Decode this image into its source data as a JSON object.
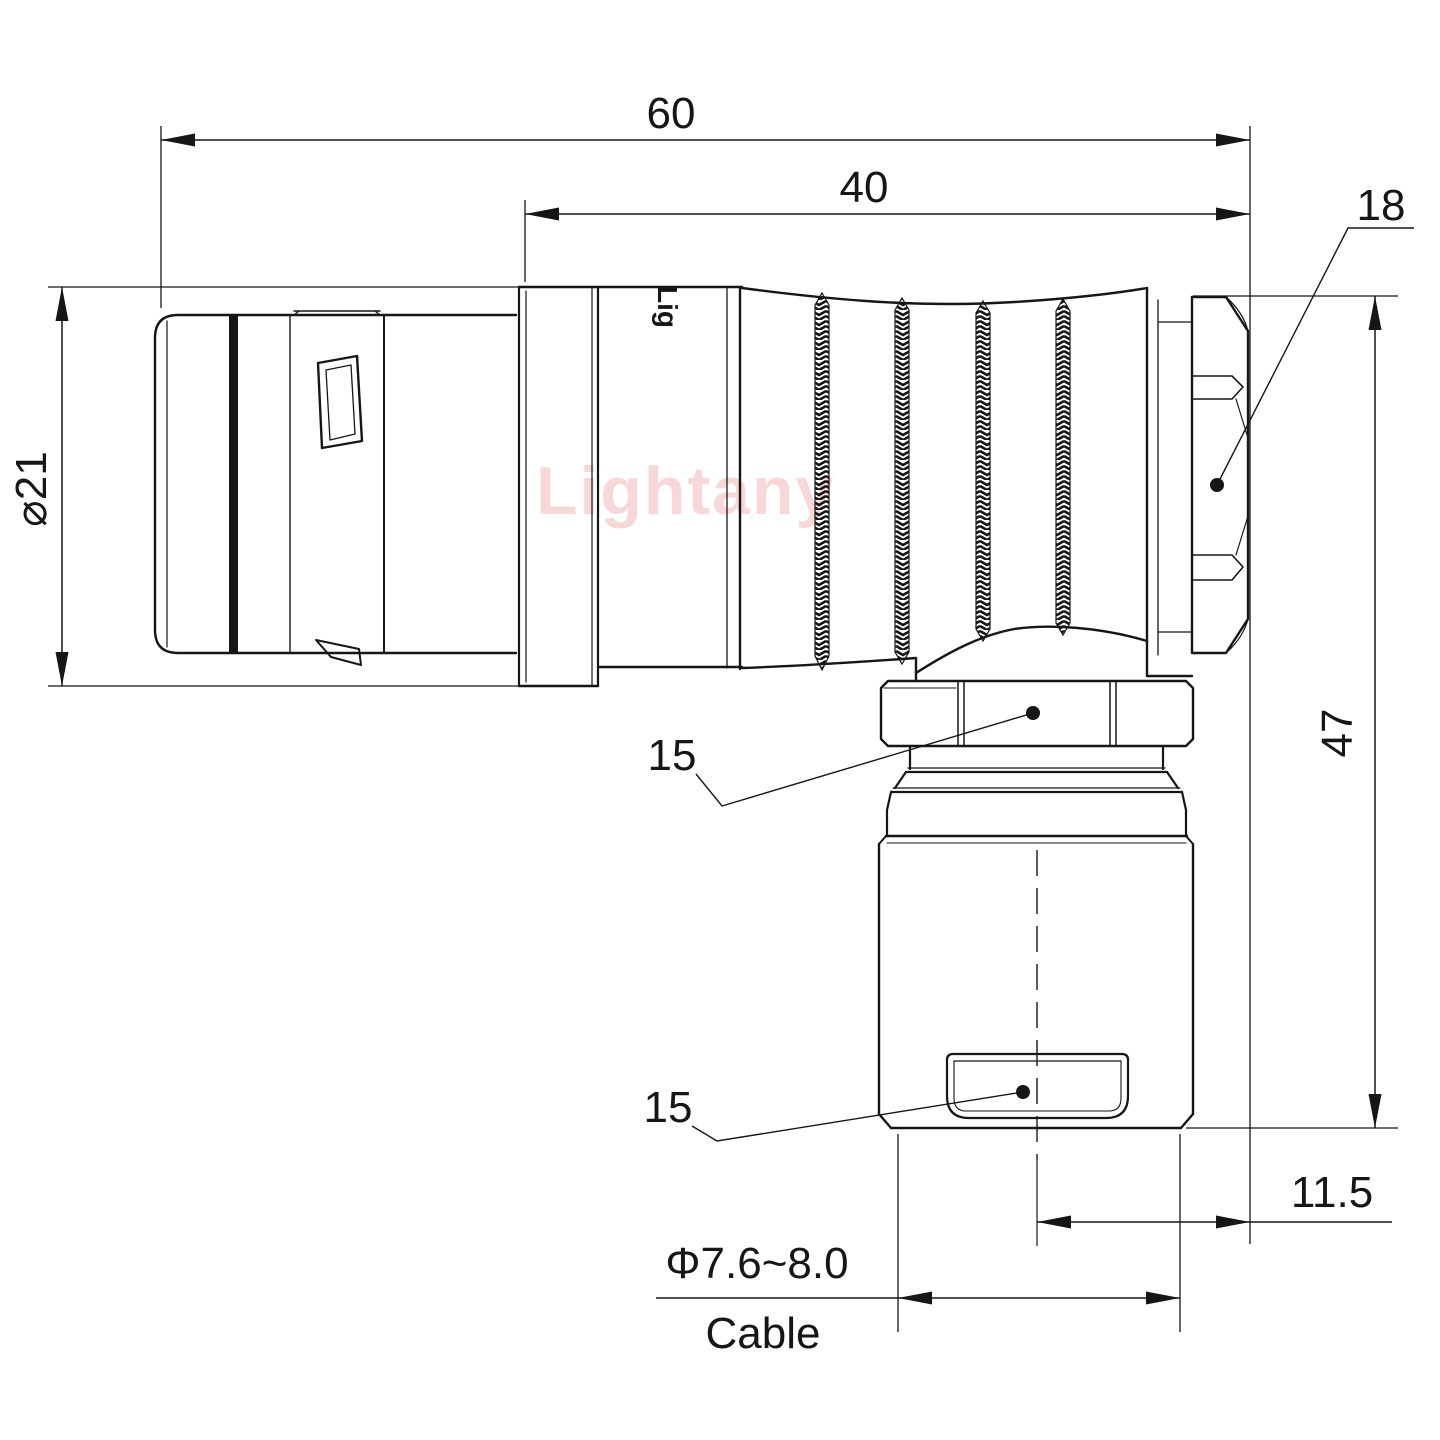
{
  "drawing": {
    "watermark": "Lightany",
    "body_logo": "Lig",
    "dimensions": {
      "overall_length": "60",
      "rear_length": "40",
      "hex_nut_width": "18",
      "front_diameter": "⌀21",
      "coupling_nut_width_upper": "15",
      "cable_nut_width_lower": "15",
      "overall_height": "47",
      "axis_offset": "11.5",
      "cable_diameter_range": "Φ7.6~8.0",
      "cable_label": "Cable"
    },
    "colors": {
      "line": "#161616",
      "watermark": "#f3bfbf",
      "background": "#ffffff"
    }
  }
}
